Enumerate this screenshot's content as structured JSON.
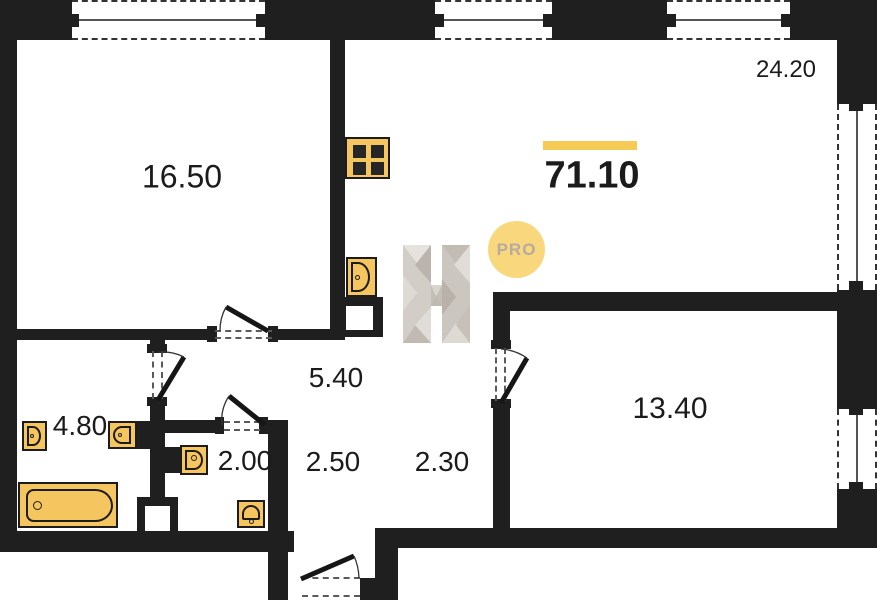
{
  "plan": {
    "total_area": "71.10",
    "areas": {
      "bedroom": "16.50",
      "living_kitchen": "24.20",
      "hall": "5.40",
      "bathroom": "4.80",
      "wc": "2.00",
      "corridor": "2.50",
      "entry": "2.30",
      "bedroom2": "13.40"
    },
    "badge": "PRO",
    "watermark_letter": "H",
    "colors": {
      "wall": "#1f1f1f",
      "fixture_fill": "#f5c55f",
      "accent_underline": "#f5ca55",
      "badge_bg": "#f8d77d",
      "badge_text": "#b5aba1"
    },
    "icons": {
      "kitchen": [
        "stove-icon",
        "sink-icon",
        "duct-shaft-icon"
      ],
      "bathroom": [
        "toilet-icon",
        "washbasin-icon",
        "bathtub-icon",
        "duct-shaft-icon"
      ],
      "wc": [
        "washbasin-icon",
        "toilet-icon"
      ],
      "brand": [
        "brand-letter-watermark-icon",
        "pro-badge"
      ]
    }
  }
}
